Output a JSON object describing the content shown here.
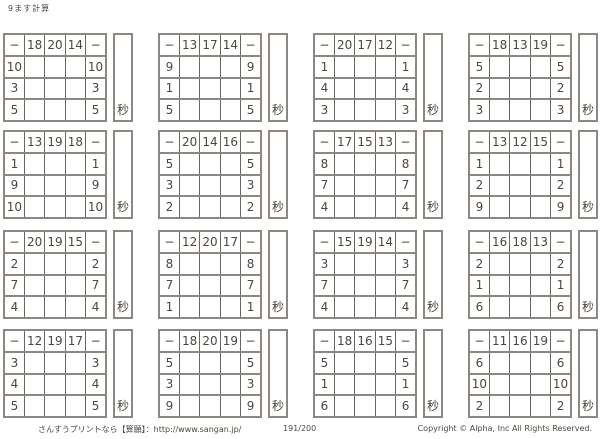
{
  "page": {
    "title": "9ます計算",
    "operator": "−",
    "seconds_label": "秒",
    "footer": {
      "left": "さんすうプリントなら【算願】：http://www.sangan.jp/",
      "page_number": "191/200",
      "copyright": "Copyright © Alpha, Inc All Rights Reserved."
    },
    "colors": {
      "outer_line": "#8d8780",
      "inner_line": "#6b665f",
      "text": "#4a4642",
      "background": "#ffffff"
    }
  },
  "tables": [
    {
      "top": [
        "18",
        "20",
        "14"
      ],
      "sides": [
        "10",
        "3",
        "5"
      ]
    },
    {
      "top": [
        "13",
        "17",
        "14"
      ],
      "sides": [
        "9",
        "1",
        "5"
      ]
    },
    {
      "top": [
        "20",
        "17",
        "12"
      ],
      "sides": [
        "1",
        "4",
        "3"
      ]
    },
    {
      "top": [
        "18",
        "13",
        "19"
      ],
      "sides": [
        "5",
        "2",
        "3"
      ]
    },
    {
      "top": [
        "13",
        "19",
        "18"
      ],
      "sides": [
        "1",
        "9",
        "10"
      ]
    },
    {
      "top": [
        "20",
        "14",
        "16"
      ],
      "sides": [
        "5",
        "3",
        "2"
      ]
    },
    {
      "top": [
        "17",
        "15",
        "13"
      ],
      "sides": [
        "8",
        "7",
        "4"
      ]
    },
    {
      "top": [
        "13",
        "12",
        "15"
      ],
      "sides": [
        "1",
        "2",
        "9"
      ]
    },
    {
      "top": [
        "20",
        "19",
        "15"
      ],
      "sides": [
        "2",
        "7",
        "4"
      ]
    },
    {
      "top": [
        "12",
        "20",
        "17"
      ],
      "sides": [
        "8",
        "7",
        "1"
      ]
    },
    {
      "top": [
        "15",
        "19",
        "14"
      ],
      "sides": [
        "3",
        "7",
        "4"
      ]
    },
    {
      "top": [
        "16",
        "18",
        "13"
      ],
      "sides": [
        "2",
        "1",
        "6"
      ]
    },
    {
      "top": [
        "12",
        "19",
        "17"
      ],
      "sides": [
        "3",
        "4",
        "5"
      ]
    },
    {
      "top": [
        "18",
        "20",
        "19"
      ],
      "sides": [
        "5",
        "3",
        "9"
      ]
    },
    {
      "top": [
        "18",
        "16",
        "15"
      ],
      "sides": [
        "5",
        "1",
        "6"
      ]
    },
    {
      "top": [
        "11",
        "16",
        "19"
      ],
      "sides": [
        "6",
        "10",
        "2"
      ]
    }
  ]
}
